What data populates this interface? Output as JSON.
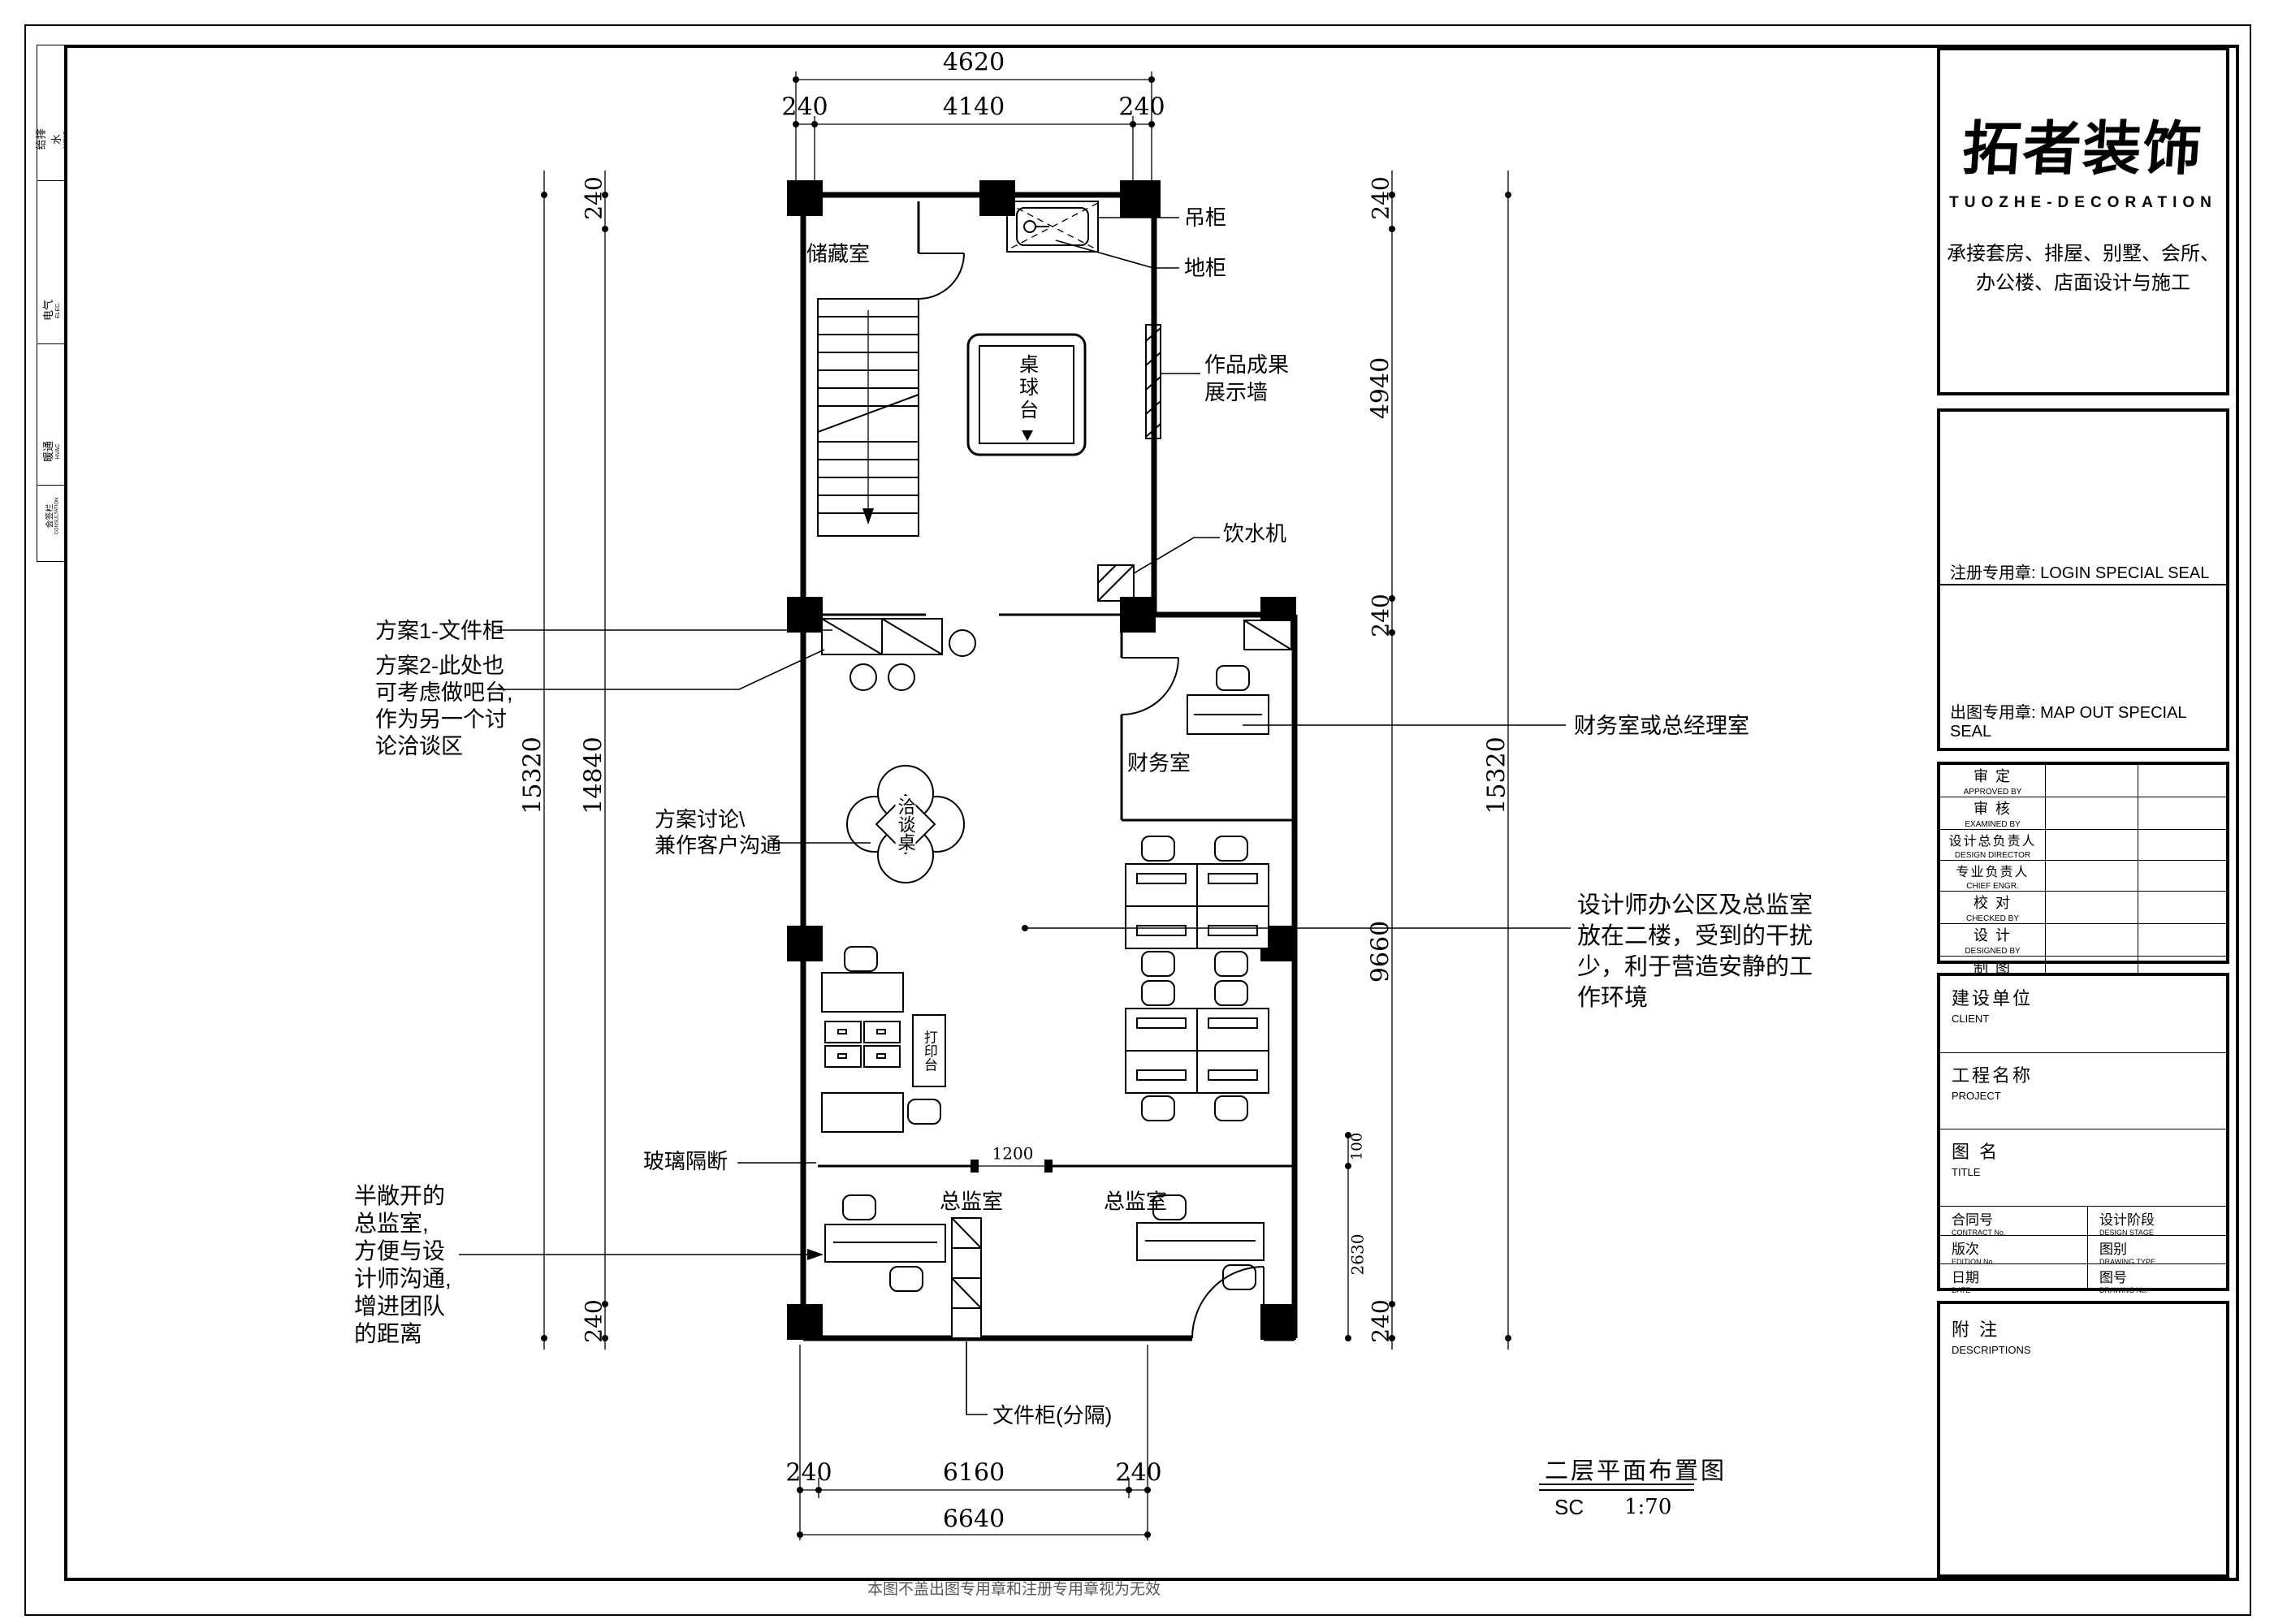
{
  "sheet": {
    "drawing_title": "二层平面布置图",
    "scale_label": "SC",
    "scale_value": "1:70",
    "bottom_note": "本图不盖出图专用章和注册专用章视为无效"
  },
  "signoff": {
    "cells": [
      {
        "cn": "给排水",
        "en": "WS&D"
      },
      {
        "cn": "电气",
        "en": "ELEC."
      },
      {
        "cn": "暖通",
        "en": "HVAC"
      },
      {
        "cn": "会签栏",
        "en": "CONSULTATION"
      }
    ]
  },
  "titleblock": {
    "logo_cn": "拓者装饰",
    "logo_en": "TUOZHE-DECORATION",
    "tagline1": "承接套房、排屋、别墅、会所、",
    "tagline2": "办公楼、店面设计与施工",
    "seal_register": "注册专用章: LOGIN SPECIAL SEAL",
    "seal_mapout": "出图专用章: MAP OUT SPECIAL SEAL",
    "approvals": [
      {
        "cn": "审 定",
        "en": "APPROVED BY"
      },
      {
        "cn": "审 核",
        "en": "EXAMINED BY"
      },
      {
        "cn": "设计总负责人",
        "en": "DESIGN DIRECTOR"
      },
      {
        "cn": "专业负责人",
        "en": "CHIEF ENGR."
      },
      {
        "cn": "校 对",
        "en": "CHECKED BY"
      },
      {
        "cn": "设 计",
        "en": "DESIGNED BY"
      },
      {
        "cn": "制 图",
        "en": "DRAWN BY"
      }
    ],
    "client": {
      "cn": "建设单位",
      "en": "CLIENT"
    },
    "project": {
      "cn": "工程名称",
      "en": "PROJECT"
    },
    "title": {
      "cn": "图 名",
      "en": "TITLE"
    },
    "meta": [
      {
        "cn": "合同号",
        "en": "CONTRACT No."
      },
      {
        "cn": "设计阶段",
        "en": "DESIGN STAGE"
      },
      {
        "cn": "版次",
        "en": "EDITION No."
      },
      {
        "cn": "图别",
        "en": "DRAWING TYPE"
      },
      {
        "cn": "日期",
        "en": "DATE"
      },
      {
        "cn": "图号",
        "en": "DRAWING No."
      }
    ],
    "notes": {
      "cn": "附 注",
      "en": "DESCRIPTIONS"
    }
  },
  "plan": {
    "rooms": {
      "storage": "储藏室",
      "finance": "财务室",
      "director_left": "总监室",
      "director_right": "总监室"
    },
    "furniture": {
      "billiard": "桌球台",
      "negotiation": "洽谈桌",
      "print": "打印台"
    },
    "callouts": {
      "hanging_cabinet": "吊柜",
      "floor_cabinet": "地柜",
      "display_wall": [
        "作品成果",
        "展示墙"
      ],
      "water_dispenser": "饮水机",
      "plan1": "方案1-文件柜",
      "plan2": [
        "方案2-此处也",
        "可考虑做吧台,",
        "作为另一个讨",
        "论洽谈区"
      ],
      "discuss": [
        "方案讨论\\",
        "兼作客户沟通"
      ],
      "finance_note": "财务室或总经理室",
      "designer_note": [
        "设计师办公区及总监室",
        "放在二楼，受到的干扰",
        "少，利于营造安静的工",
        "作环境"
      ],
      "glass": "玻璃隔断",
      "semi_open": [
        "半敞开的",
        "总监室,",
        "方便与设",
        "计师沟通,",
        "增进团队",
        "的距离"
      ],
      "file_cabinet": "文件柜(分隔)"
    },
    "dims": {
      "top_total": "4620",
      "top": [
        "240",
        "4140",
        "240"
      ],
      "left": {
        "t240": "240",
        "d15320": "15320",
        "d14840": "14840",
        "b240": "240"
      },
      "right": {
        "t240": "240",
        "d4940": "4940",
        "m240": "240",
        "d9660": "9660",
        "b240": "240",
        "d15320": "15320"
      },
      "bottom": [
        "240",
        "6160",
        "240"
      ],
      "bottom_total": "6640",
      "inner_1200": "1200",
      "inner_100": "100",
      "inner_2630": "2630"
    }
  }
}
